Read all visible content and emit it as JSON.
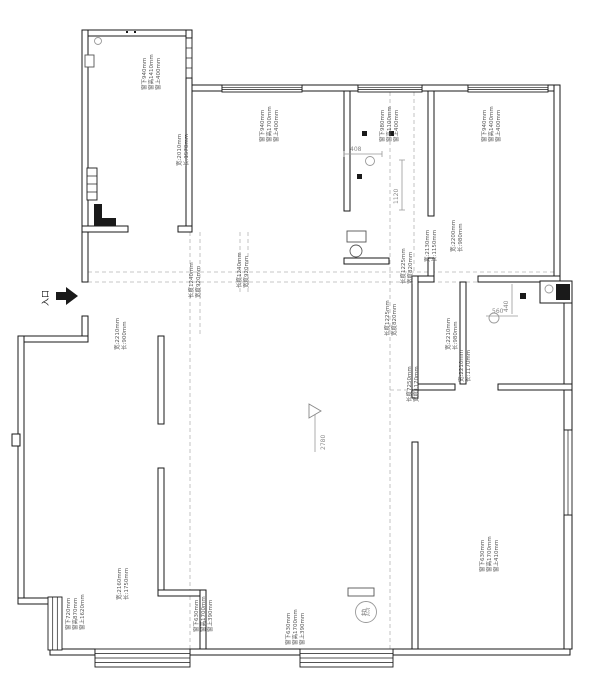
{
  "colors": {
    "wall": "#1a1a1a",
    "dash": "#b5b5b5",
    "text": "#555555",
    "dim": "#999999"
  },
  "entrance_label": "入口",
  "heater_label": "热",
  "level_mark": "2780",
  "dims": {
    "d408": "408",
    "d1120": "1120",
    "d440": "440",
    "d560": "560"
  },
  "window_specs": {
    "tl": {
      "top": "窗上400mm",
      "height": "窗高1410mm",
      "bottom": "窗下940mm"
    },
    "tm": {
      "top": "窗上400mm",
      "height": "窗高1700mm",
      "bottom": "窗下940mm"
    },
    "bath": {
      "top": "窗上400mm",
      "height": "窗高1100mm",
      "bottom": "窗下980mm"
    },
    "tr": {
      "top": "窗上400mm",
      "height": "窗高1400mm",
      "bottom": "窗下940mm"
    },
    "bl": {
      "top": "窗上1620mm",
      "height": "窗高870mm",
      "bottom": "窗下720mm"
    },
    "bm1": {
      "top": "窗上390mm",
      "height": "窗高1700mm",
      "bottom": "窗下630mm"
    },
    "bm2": {
      "top": "窗上390mm",
      "height": "窗高1700mm",
      "bottom": "窗下630mm"
    },
    "br": {
      "top": "窗上410mm",
      "height": "窗高1700mm",
      "bottom": "窗下630mm"
    }
  },
  "room_dims": {
    "tl_inner": {
      "a": "长:1570mm",
      "b": "宽:2010mm"
    },
    "hall_upper": {
      "a": "长:1150mm",
      "b": "宽:2130mm"
    },
    "bath_right": {
      "a": "长:980mm",
      "b": "宽:2200mm"
    },
    "left_mid": {
      "a": "长:900mm",
      "b": "宽:2210mm"
    },
    "right_mid": {
      "a": "长:980mm",
      "b": "宽:2210mm"
    },
    "right_mid2": {
      "a": "长:1170mm",
      "b": "宽:2210mm"
    },
    "bottom_left": {
      "a": "长:1750mm",
      "b": "宽:2160mm"
    }
  },
  "passage_dims": {
    "p1": {
      "a": "宽度920mm",
      "b": "长度1240mm"
    },
    "p2": {
      "a": "宽度920mm",
      "b": "长度1240mm"
    },
    "p3": {
      "a": "宽度820mm",
      "b": "长度1225mm"
    },
    "p4": {
      "a": "宽度820mm",
      "b": "长度1225mm"
    },
    "corridor": {
      "a": "宽度1170mm",
      "b": "长度7250mm"
    }
  }
}
